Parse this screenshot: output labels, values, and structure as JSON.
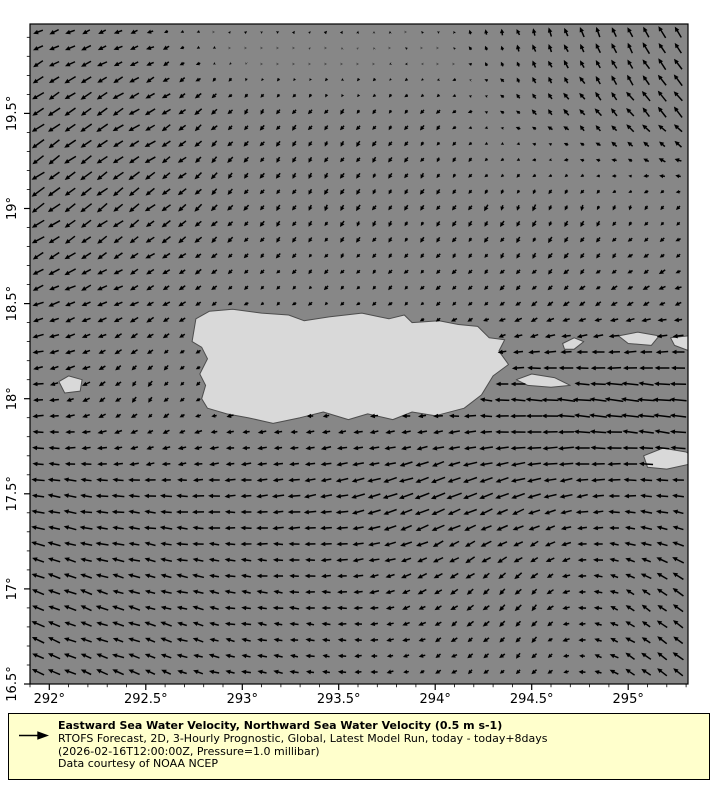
{
  "chart_data": {
    "type": "quiver",
    "title": "",
    "xlabel": "",
    "ylabel": "",
    "x_axis": {
      "lon_min": 291.9,
      "lon_max": 295.31,
      "major_tick_values": [
        292,
        292.5,
        293,
        293.5,
        294,
        294.5,
        295
      ],
      "major_tick_labels": [
        "292°",
        "292.5°",
        "293°",
        "293.5°",
        "294°",
        "294.5°",
        "295°"
      ],
      "minor_tick_step": 0.1
    },
    "y_axis": {
      "lat_min": 16.5,
      "lat_max": 19.97,
      "major_tick_values": [
        16.5,
        17,
        17.5,
        18,
        18.5,
        19,
        19.5
      ],
      "major_tick_labels": [
        "16.5°",
        "17°",
        "17.5°",
        "18°",
        "18.5°",
        "19°",
        "19.5°"
      ],
      "minor_tick_step": 0.1
    },
    "reference_vector_ms": 0.5,
    "arrow_grid_spacing_deg": 0.083,
    "colors": {
      "ocean": "#878787",
      "land": "#d9d9d9",
      "coastline": "#4d4d4d",
      "arrow": "#000000",
      "frame": "#000000",
      "legend_bg": "#ffffcc",
      "page_bg": "#ffffff"
    },
    "control_field": {
      "comment": "coarse sampled sea-water velocity field (m/s), u eastward / v northward, rows = lats ascending",
      "lons": [
        291.9,
        292.5,
        293.0,
        293.5,
        294.0,
        294.5,
        295.0,
        295.35
      ],
      "lats": [
        16.5,
        17.0,
        17.5,
        18.0,
        18.5,
        19.0,
        19.5,
        19.97
      ],
      "u": [
        [
          -0.3,
          -0.26,
          -0.22,
          -0.18,
          -0.12,
          -0.1,
          -0.22,
          -0.26
        ],
        [
          -0.32,
          -0.28,
          -0.26,
          -0.24,
          -0.2,
          -0.14,
          -0.22,
          -0.26
        ],
        [
          -0.32,
          -0.3,
          -0.28,
          -0.32,
          -0.38,
          -0.32,
          -0.3,
          -0.3
        ],
        [
          -0.26,
          -0.08,
          -0.14,
          -0.14,
          -0.18,
          -0.42,
          -0.46,
          -0.42
        ],
        [
          -0.28,
          -0.2,
          -0.1,
          -0.08,
          -0.1,
          -0.13,
          -0.16,
          -0.18
        ],
        [
          -0.3,
          -0.24,
          -0.11,
          -0.08,
          -0.08,
          -0.06,
          -0.06,
          -0.1
        ],
        [
          -0.3,
          -0.26,
          -0.1,
          -0.08,
          -0.08,
          -0.1,
          -0.18,
          -0.24
        ],
        [
          -0.24,
          -0.16,
          0.07,
          0.05,
          -0.02,
          -0.05,
          -0.12,
          -0.2
        ]
      ],
      "v": [
        [
          0.14,
          0.1,
          0.06,
          0.02,
          -0.06,
          -0.12,
          0.16,
          0.22
        ],
        [
          0.12,
          0.08,
          0.04,
          0.0,
          -0.12,
          -0.16,
          0.12,
          0.2
        ],
        [
          0.06,
          0.02,
          -0.02,
          -0.06,
          -0.16,
          -0.1,
          0.0,
          0.04
        ],
        [
          -0.02,
          -0.14,
          -0.02,
          -0.02,
          0.02,
          0.04,
          0.05,
          0.05
        ],
        [
          -0.1,
          -0.1,
          -0.07,
          -0.07,
          -0.09,
          -0.1,
          -0.08,
          -0.05
        ],
        [
          -0.22,
          -0.19,
          -0.14,
          -0.14,
          -0.13,
          -0.15,
          -0.12,
          -0.1
        ],
        [
          -0.2,
          -0.16,
          -0.12,
          -0.12,
          -0.1,
          0.1,
          0.22,
          0.26
        ],
        [
          -0.1,
          -0.06,
          0.05,
          0.07,
          0.05,
          0.2,
          0.27,
          0.28
        ]
      ]
    },
    "land_polygons": [
      {
        "name": "puerto-rico",
        "points": [
          [
            292.74,
            18.3
          ],
          [
            292.76,
            18.42
          ],
          [
            292.83,
            18.46
          ],
          [
            292.95,
            18.47
          ],
          [
            293.1,
            18.45
          ],
          [
            293.24,
            18.44
          ],
          [
            293.32,
            18.41
          ],
          [
            293.45,
            18.43
          ],
          [
            293.62,
            18.45
          ],
          [
            293.76,
            18.42
          ],
          [
            293.84,
            18.44
          ],
          [
            293.88,
            18.4
          ],
          [
            294.02,
            18.41
          ],
          [
            294.12,
            18.39
          ],
          [
            294.22,
            18.38
          ],
          [
            294.28,
            18.32
          ],
          [
            294.36,
            18.31
          ],
          [
            294.33,
            18.25
          ],
          [
            294.38,
            18.18
          ],
          [
            294.3,
            18.12
          ],
          [
            294.24,
            18.02
          ],
          [
            294.15,
            17.95
          ],
          [
            294.0,
            17.91
          ],
          [
            293.88,
            17.93
          ],
          [
            293.78,
            17.89
          ],
          [
            293.65,
            17.92
          ],
          [
            293.55,
            17.89
          ],
          [
            293.42,
            17.93
          ],
          [
            293.3,
            17.9
          ],
          [
            293.16,
            17.87
          ],
          [
            293.03,
            17.9
          ],
          [
            292.92,
            17.92
          ],
          [
            292.82,
            17.95
          ],
          [
            292.79,
            18.0
          ],
          [
            292.81,
            18.07
          ],
          [
            292.78,
            18.13
          ],
          [
            292.82,
            18.21
          ],
          [
            292.79,
            18.27
          ]
        ]
      },
      {
        "name": "mona",
        "points": [
          [
            292.05,
            18.09
          ],
          [
            292.1,
            18.12
          ],
          [
            292.17,
            18.1
          ],
          [
            292.16,
            18.04
          ],
          [
            292.08,
            18.03
          ]
        ]
      },
      {
        "name": "vieques",
        "points": [
          [
            294.42,
            18.1
          ],
          [
            294.5,
            18.13
          ],
          [
            294.62,
            18.11
          ],
          [
            294.7,
            18.07
          ],
          [
            294.6,
            18.06
          ],
          [
            294.48,
            18.07
          ]
        ]
      },
      {
        "name": "culebra",
        "points": [
          [
            294.66,
            18.29
          ],
          [
            294.72,
            18.32
          ],
          [
            294.77,
            18.3
          ],
          [
            294.72,
            18.26
          ],
          [
            294.67,
            18.26
          ]
        ]
      },
      {
        "name": "st-thomas",
        "points": [
          [
            294.95,
            18.33
          ],
          [
            295.05,
            18.35
          ],
          [
            295.16,
            18.33
          ],
          [
            295.12,
            18.28
          ],
          [
            295.0,
            18.29
          ]
        ]
      },
      {
        "name": "tortola",
        "points": [
          [
            295.22,
            18.32
          ],
          [
            295.4,
            18.34
          ],
          [
            295.4,
            18.22
          ],
          [
            295.24,
            18.28
          ]
        ]
      },
      {
        "name": "st-croix",
        "points": [
          [
            295.08,
            17.7
          ],
          [
            295.18,
            17.74
          ],
          [
            295.3,
            17.72
          ],
          [
            295.38,
            17.67
          ],
          [
            295.2,
            17.63
          ],
          [
            295.1,
            17.64
          ]
        ]
      }
    ]
  },
  "legend": {
    "title_bold": "Eastward Sea Water Velocity, Northward Sea Water Velocity (0.5 m s-1)",
    "line2": "RTOFS Forecast, 2D, 3-Hourly Prognostic, Global, Latest Model Run, today - today+8days",
    "line3": "(2026-02-16T12:00:00Z, Pressure=1.0 millibar)",
    "line4": "Data courtesy of NOAA NCEP"
  }
}
